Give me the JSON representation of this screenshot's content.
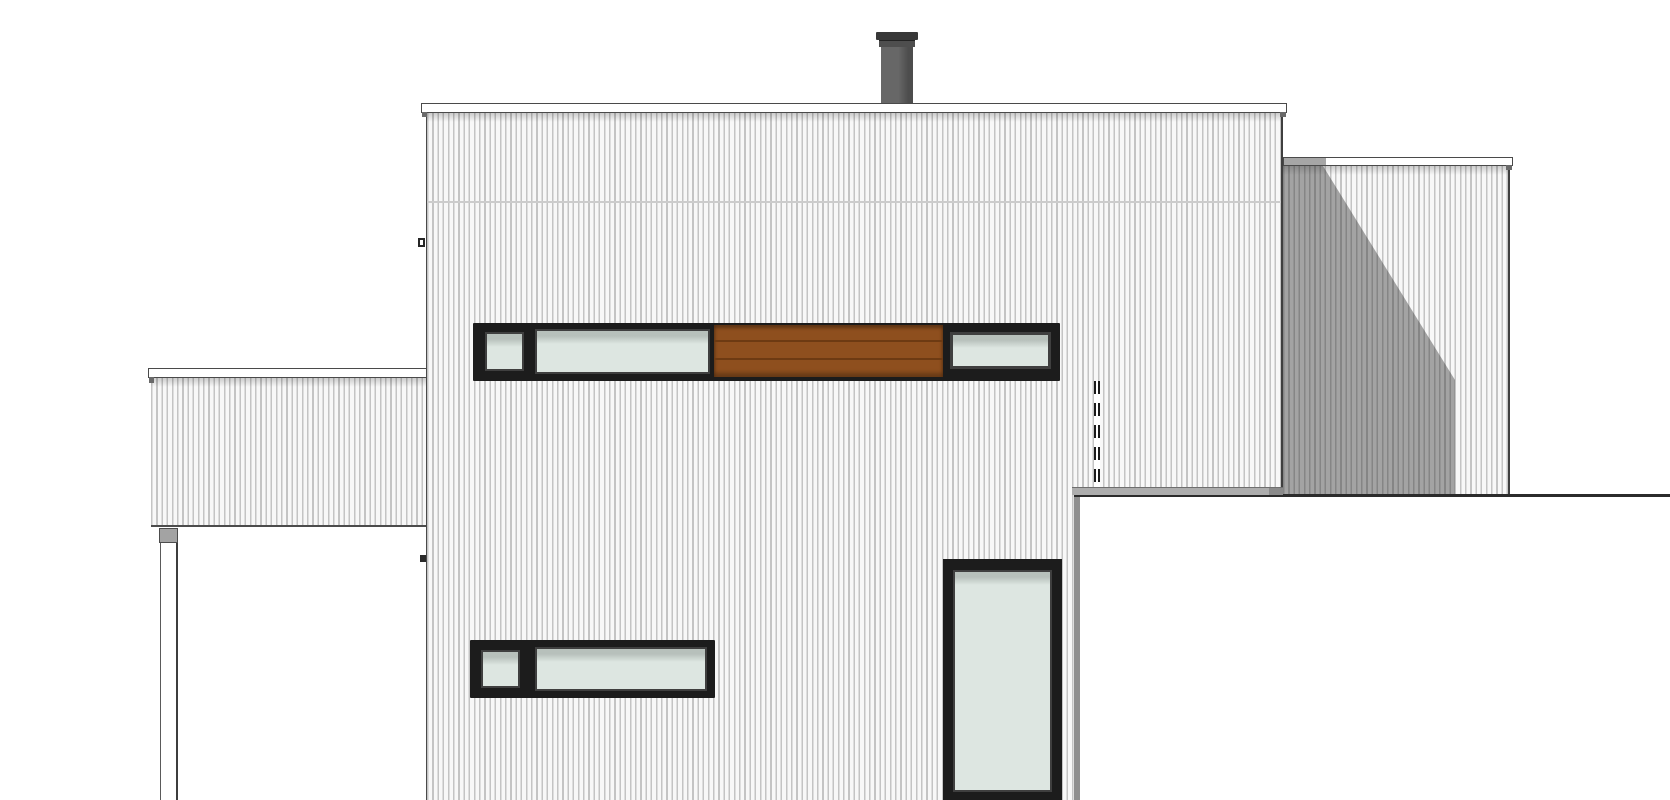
{
  "document": {
    "type": "architectural-elevation",
    "description": "Side elevation drawing of a flat-roofed house with vertical corrugated siding, horizontal window bands, wood-slat infill panel, chimney flue, low left wing on a post, shadowed right extension and white foreground volume",
    "text_content": []
  },
  "palette": {
    "paper": "#ffffff",
    "line": "#4a4a4a",
    "edge_dark": "#2b2b2b",
    "siding_bg": "#f8f8f8",
    "siding_stripe": "#c4c4c4",
    "frame_dark": "#1c1c1c",
    "frame_mid": "#3f3f3f",
    "glass": "#dde6e1",
    "glass_shadow": "#b7c0bb",
    "wood": "#8e4f1e",
    "wood_line": "#6d3a12",
    "shadow": "rgba(45,45,45,0.42)",
    "flashing": "#adadad",
    "flashing_end": "#8a8a8a",
    "chimney_cap": "#383838",
    "chimney_collar": "#4e4e4e",
    "chimney_body": "#676767",
    "chimney_body_dark": "#4d4d4d",
    "post_cap": "#a3a3a3"
  },
  "scene": {
    "canvas": {
      "width": 1670,
      "height": 800
    },
    "elements": [
      {
        "name": "chimney-flue",
        "bbox": [
          876,
          32,
          42,
          76
        ]
      },
      {
        "name": "main-roof-fascia",
        "bbox": [
          421,
          103,
          866,
          10
        ]
      },
      {
        "name": "main-wall",
        "bbox": [
          426,
          113,
          857,
          687
        ],
        "cladding": "vertical-siding",
        "floor_line_y": 202
      },
      {
        "name": "upper-window-band",
        "bbox": [
          473,
          323,
          587,
          58
        ],
        "parts": [
          "small-window",
          "long-window",
          "wood-slat-panel",
          "right-window"
        ]
      },
      {
        "name": "wood-slat-panel",
        "bbox": [
          714,
          325,
          229,
          52
        ],
        "boards": 3
      },
      {
        "name": "lower-window-band",
        "bbox": [
          470,
          640,
          245,
          58
        ],
        "parts": [
          "small-window",
          "long-window"
        ]
      },
      {
        "name": "tall-window",
        "bbox": [
          943,
          559,
          119,
          241
        ]
      },
      {
        "name": "left-wing",
        "bbox": [
          148,
          368,
          279,
          159
        ],
        "cladding": "vertical-siding"
      },
      {
        "name": "carport-post",
        "bbox": [
          159,
          528,
          19,
          272
        ]
      },
      {
        "name": "right-extension",
        "bbox": [
          1283,
          157,
          230,
          337
        ],
        "cladding": "vertical-siding",
        "shadow": "diagonal-from-top-left"
      },
      {
        "name": "hidden-edge-dashed-line",
        "bbox": [
          1094,
          381,
          6,
          106
        ]
      },
      {
        "name": "parapet-flashing",
        "bbox": [
          1072,
          487,
          211,
          8
        ]
      },
      {
        "name": "foreground-building",
        "bbox": [
          1074,
          487,
          596,
          313
        ],
        "fill": "white"
      }
    ]
  }
}
